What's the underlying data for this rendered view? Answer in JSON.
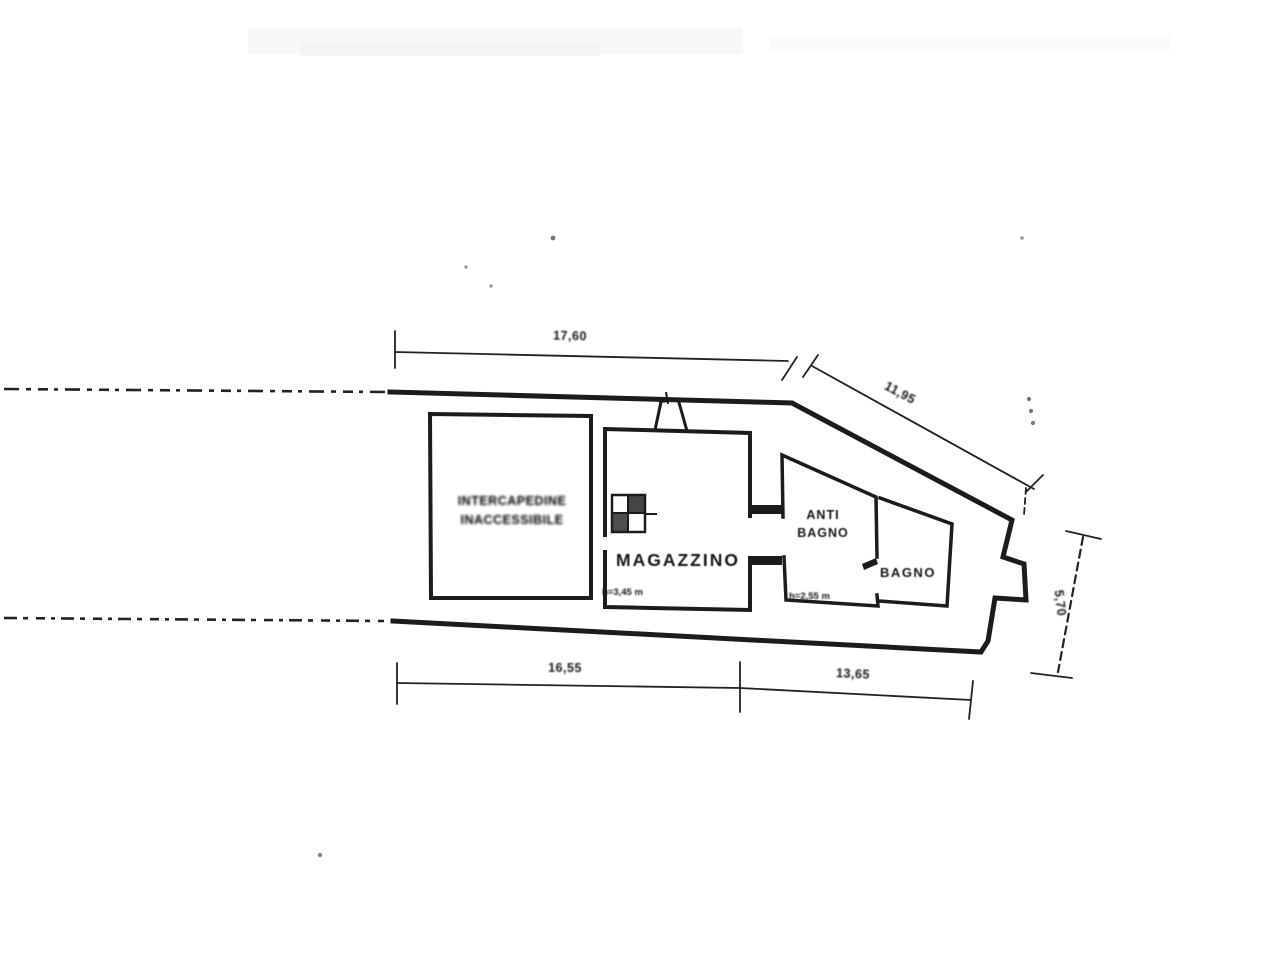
{
  "plan": {
    "rooms": {
      "cavity": {
        "label_line1": "INTERCAPEDINE",
        "label_line2": "INACCESSIBILE"
      },
      "magazzino": {
        "label": "MAGAZZINO",
        "height_note": "h=3,45 m"
      },
      "antibagno": {
        "label_line1": "ANTI",
        "label_line2": "BAGNO",
        "height_note": "h=2,55 m"
      },
      "bagno": {
        "label": "BAGNO"
      }
    },
    "dimensions": {
      "top_width": "17,60",
      "upper_right_diagonal": "11,95",
      "bottom_left_width": "16,55",
      "bottom_right_width": "13,65",
      "right_depth": "5,70"
    },
    "colors": {
      "ink": "#1c1c1c",
      "paper": "#ffffff"
    }
  }
}
